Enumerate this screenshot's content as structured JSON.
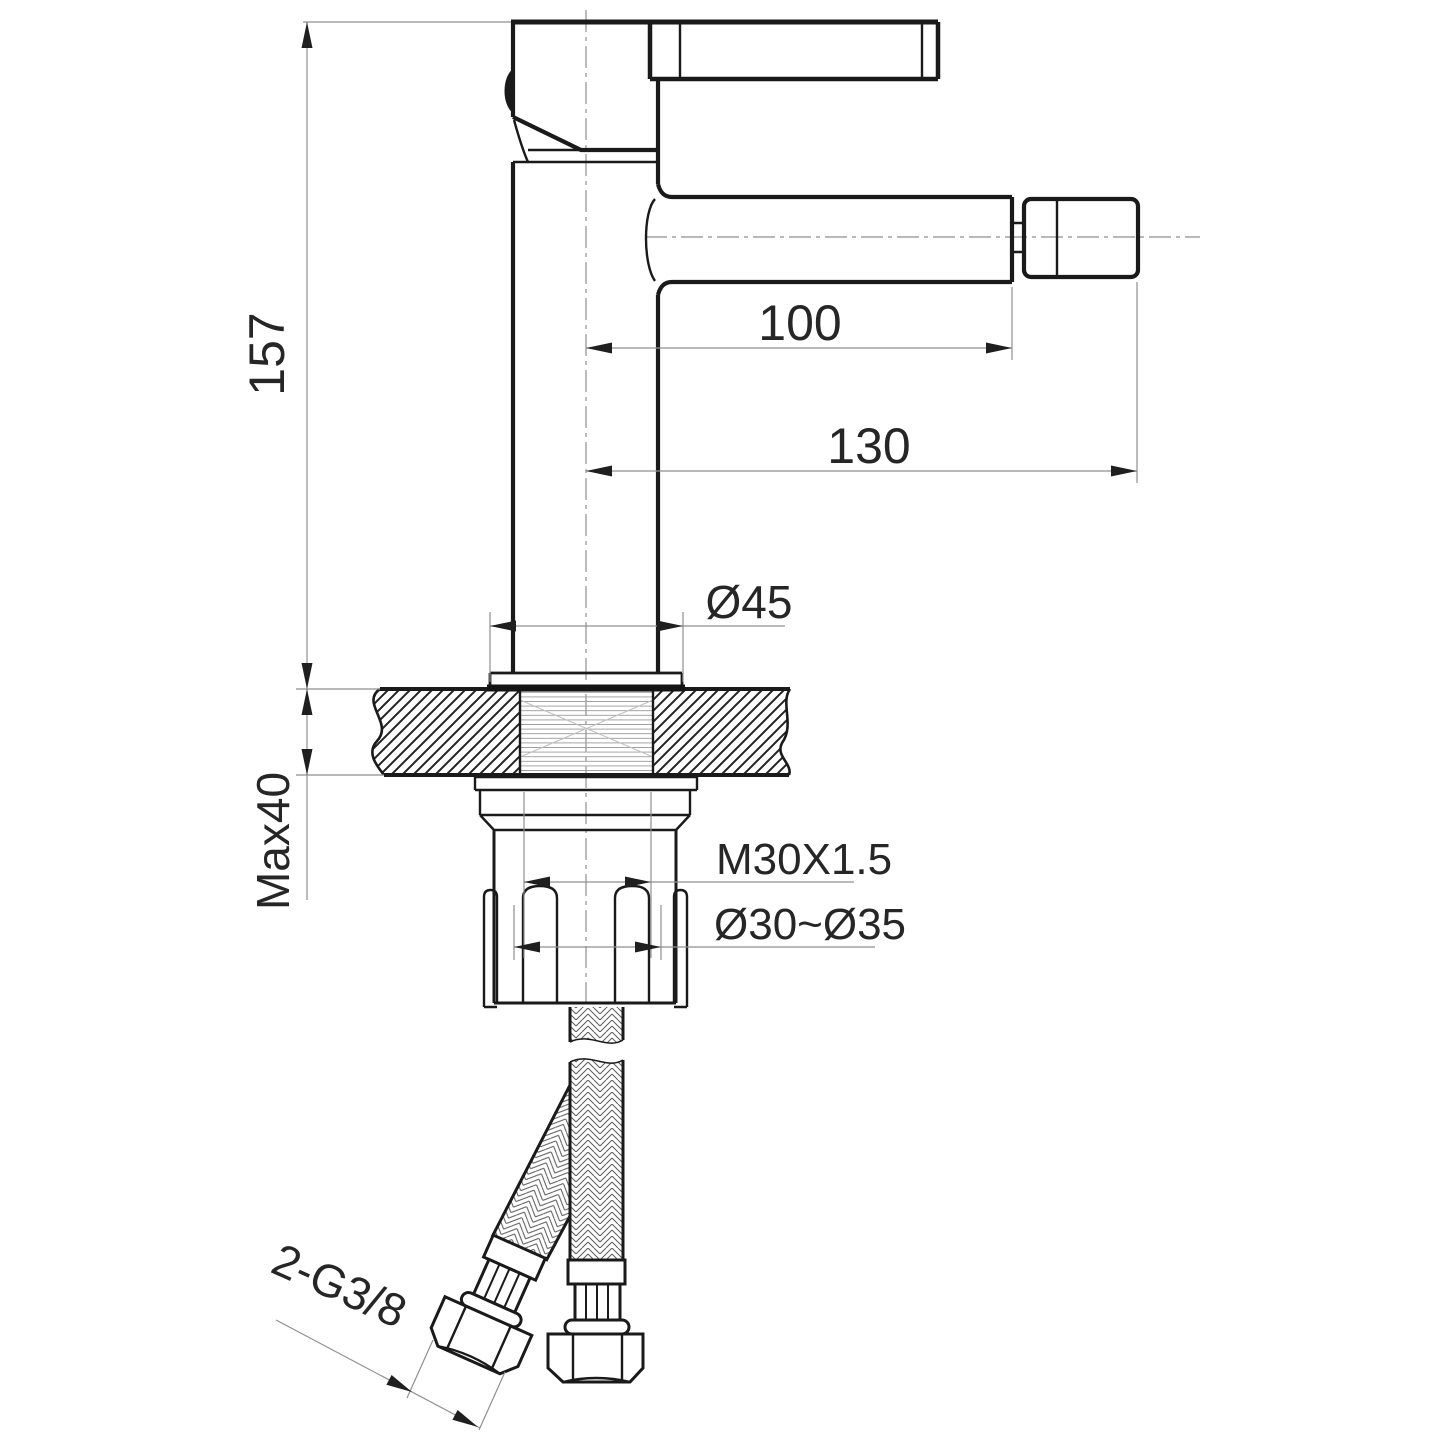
{
  "drawing": {
    "kind": "technical-dimension-drawing",
    "colors": {
      "outline": "#1a1a1a",
      "dimension_line": "#8f8f8f",
      "text": "#262626",
      "background": "#ffffff"
    },
    "dims": {
      "height": "157",
      "spout_reach": "100",
      "overall_reach": "130",
      "base_diameter": "Ø45",
      "deck_thickness": "Max40",
      "shank_thread": "M30X1.5",
      "hole_diameter": "Ø30~Ø35",
      "hose_thread": "2-G3/8"
    }
  }
}
